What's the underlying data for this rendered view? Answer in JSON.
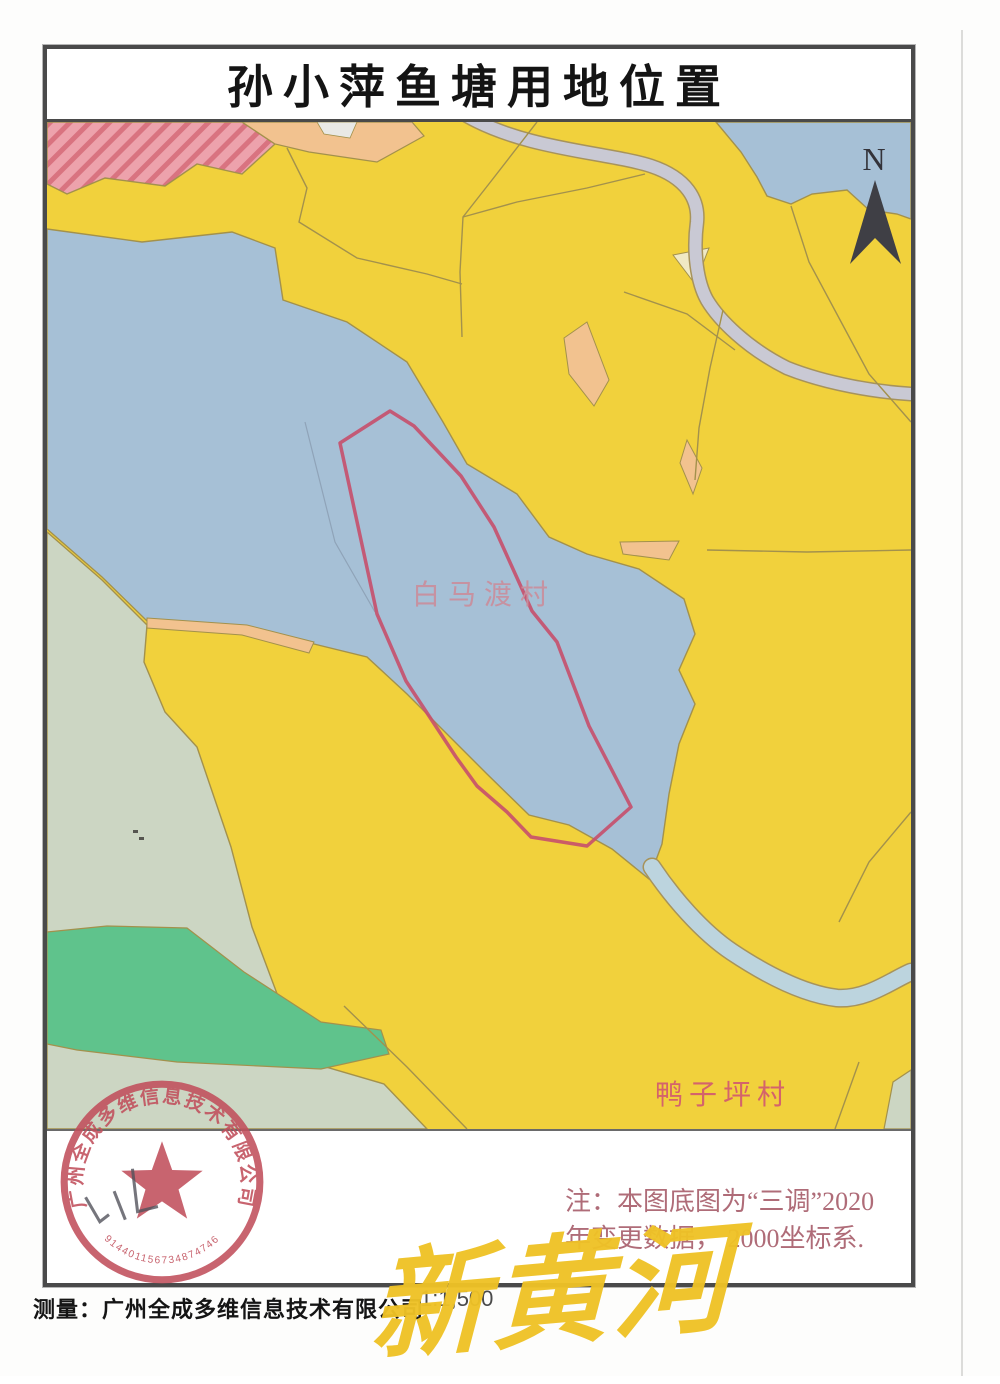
{
  "document": {
    "title": "孙小萍鱼塘用地位置",
    "north_label": "N",
    "note": {
      "line1": "注：本图底图为“三调”2020",
      "line2": "年变更数据，   2000坐标系."
    },
    "scale_text": "1:1,500",
    "surveyor_text": "测量：广州全成多维信息技术有限公司",
    "watermark_text": "新黄河"
  },
  "map": {
    "village_labels": [
      {
        "name": "白马渡村"
      },
      {
        "name": "鸭子坪村"
      }
    ],
    "parcel_outline_color": "#C64F6B"
  },
  "stamp": {
    "company": "广州全成多维信息技术有限公司",
    "registration_number": "914401156734874746"
  },
  "colors": {
    "farmland_yellow": "#F1D13C",
    "water_blue": "#A6C0D6",
    "stream_blue": "#BCD4DE",
    "grass_sage": "#CCD6C3",
    "forest_green": "#5FC38C",
    "builtup_pink": "#EDA2AC",
    "orchard_peach": "#F2C28F",
    "road_gray": "#C9C9D4",
    "boundary_olive": "#A3914C",
    "stamp_red": "#C14F5C",
    "watermark_yellow": "#EFC226",
    "note_text": "#AF6C78"
  }
}
